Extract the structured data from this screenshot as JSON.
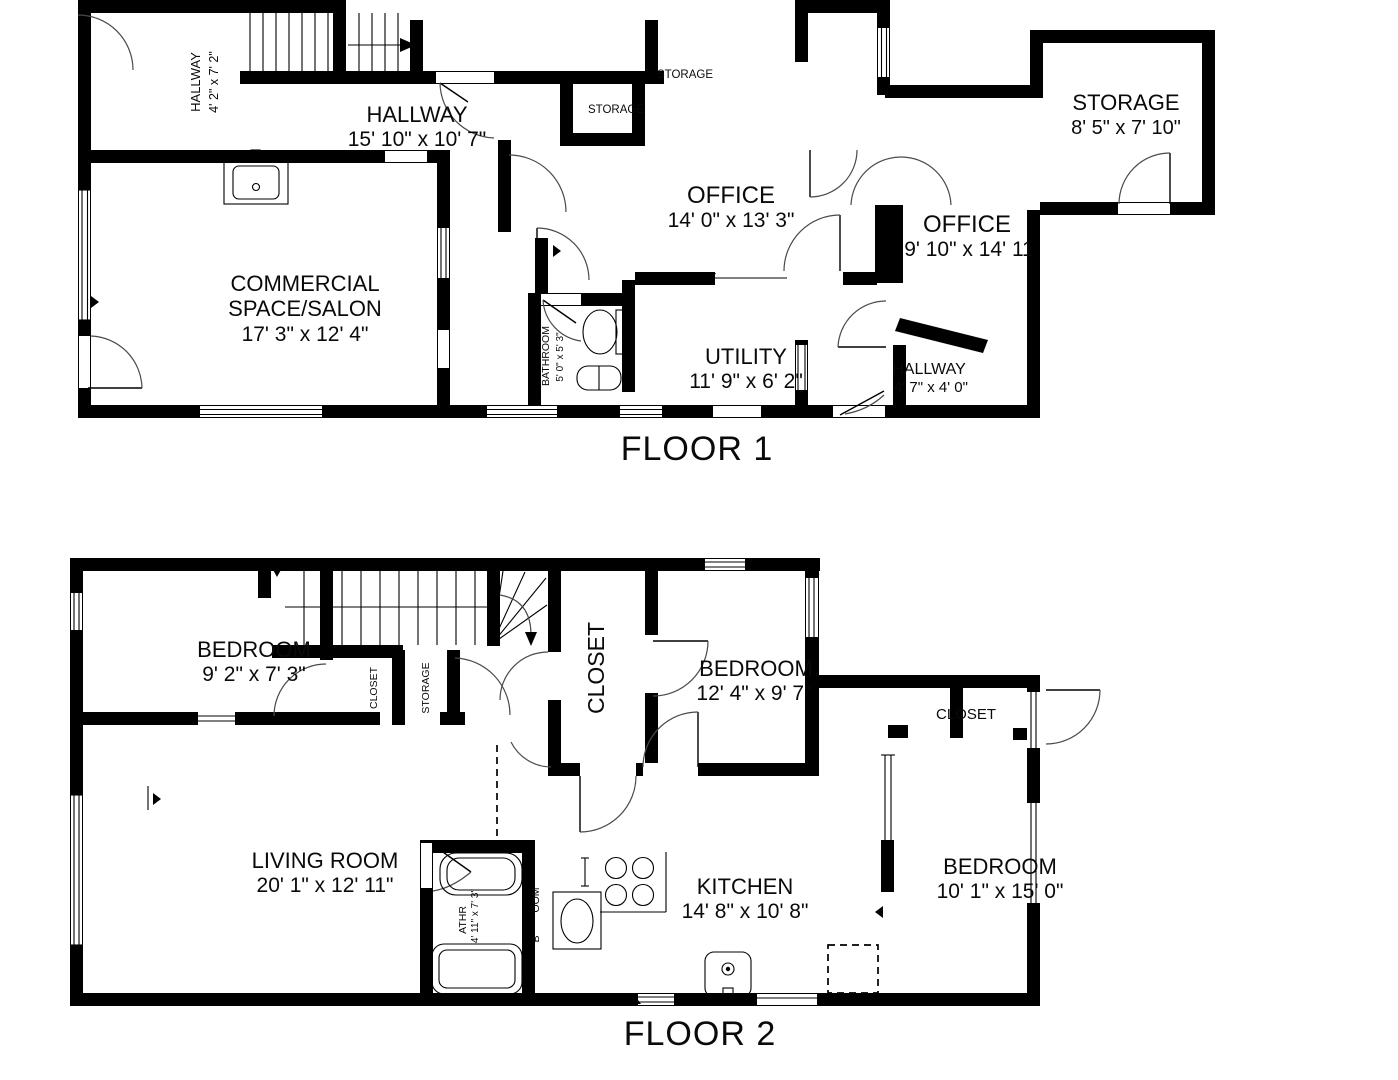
{
  "colors": {
    "wall": "#000000",
    "background": "#ffffff",
    "door_arc": "#4a4a4a"
  },
  "floor1": {
    "title": "FLOOR 1",
    "hallway_small": {
      "name": "HALLWAY",
      "dims": "4' 2\" x 7' 2\""
    },
    "hallway_main": {
      "name": "HALLWAY",
      "dims": "15' 10\" x 10' 7\""
    },
    "storage_top": {
      "name": "STORAGE"
    },
    "storage_mid": {
      "name": "STORAGE"
    },
    "storage_right": {
      "name": "STORAGE",
      "dims": "8' 5\" x 7' 10\""
    },
    "office_main": {
      "name": "OFFICE",
      "dims": "14' 0\" x 13' 3\""
    },
    "office_right": {
      "name": "OFFICE",
      "dims": "9' 10\" x 14' 11"
    },
    "commercial": {
      "name_line1": "COMMERCIAL",
      "name_line2": "SPACE/SALON",
      "dims": "17' 3\" x 12' 4\""
    },
    "bathroom": {
      "name": "BATHROOM",
      "dims": "5' 0\" x 5' 3\""
    },
    "utility": {
      "name": "UTILITY",
      "dims": "11' 9\" x 6' 2\""
    },
    "hallway_right": {
      "name": "HALLWAY",
      "dims": "4' 7\" x 4' 0\""
    }
  },
  "floor2": {
    "title": "FLOOR 2",
    "bedroom_left": {
      "name": "BEDROOM",
      "dims": "9' 2\" x 7' 3\""
    },
    "closet_small": {
      "name": "CLOSET"
    },
    "storage_small": {
      "name": "STORAGE"
    },
    "closet_large": {
      "name": "CLOSET"
    },
    "bedroom_mid": {
      "name": "BEDROOM",
      "dims": "12' 4\" x 9' 7\""
    },
    "closet_right": {
      "name": "CLOSET"
    },
    "living_room": {
      "name": "LIVING ROOM",
      "dims": "20' 1\" x 12' 11\""
    },
    "bathroom": {
      "name": "ATHR",
      "dims": "4' 11\" x 7' 3\""
    },
    "label_fragment_oom": {
      "text": "OOM"
    },
    "label_fragment_b": {
      "text": "B"
    },
    "kitchen": {
      "name": "KITCHEN",
      "dims": "14' 8\" x 10' 8\""
    },
    "bedroom_right": {
      "name": "BEDROOM",
      "dims": "10' 1\" x 15' 0\""
    }
  }
}
